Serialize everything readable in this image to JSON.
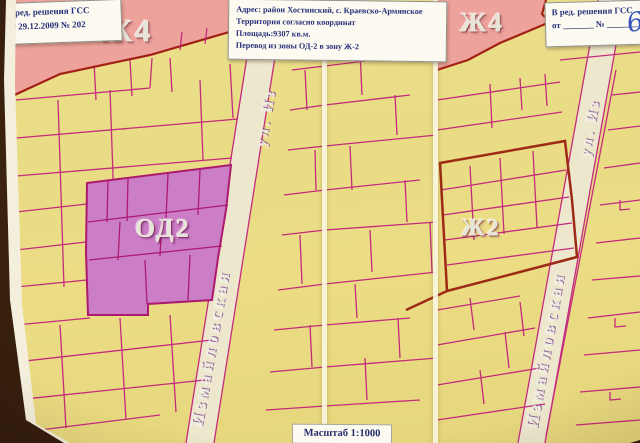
{
  "map": {
    "labels": {
      "zone_top_left": "Ж4",
      "zone_top_right": "Ж4",
      "zone_od2": "ОД2",
      "zone_zh2": "Ж2",
      "street_left_top": "ул. Из",
      "street_left_bottom": "Измайловская",
      "street_right_top": "ул. Из",
      "street_right_bottom": "Измайловская"
    },
    "scale_label": "Масштаб 1:1000"
  },
  "notes": {
    "top_left": {
      "line1": "В ред. решения ГСС",
      "line2": "от 29.12.2009 № 202"
    },
    "address": {
      "line1": "Адрес: район Хостинский, с. Краевско-Армянское",
      "line2": "Территория согласно координат",
      "line3": "Площадь:9307 кв.м.",
      "line4": "Перевод из зоны ОД-2 в зону Ж-2"
    },
    "top_right": {
      "line1": "В ред. решения ГСС",
      "line2": "от _______  № _______",
      "handwritten": "6"
    }
  },
  "colors": {
    "paper_yellow": "#e9dc85",
    "parcel_line_magenta": "#c2217c",
    "zone_pink": "#eda29b",
    "zone_purple": "#cb7ec5",
    "zone_border_dark_red": "#9c2a14",
    "street_beige": "#ece7cd",
    "note_text_navy": "#27307a",
    "handwriting_blue": "#3b55bb"
  }
}
